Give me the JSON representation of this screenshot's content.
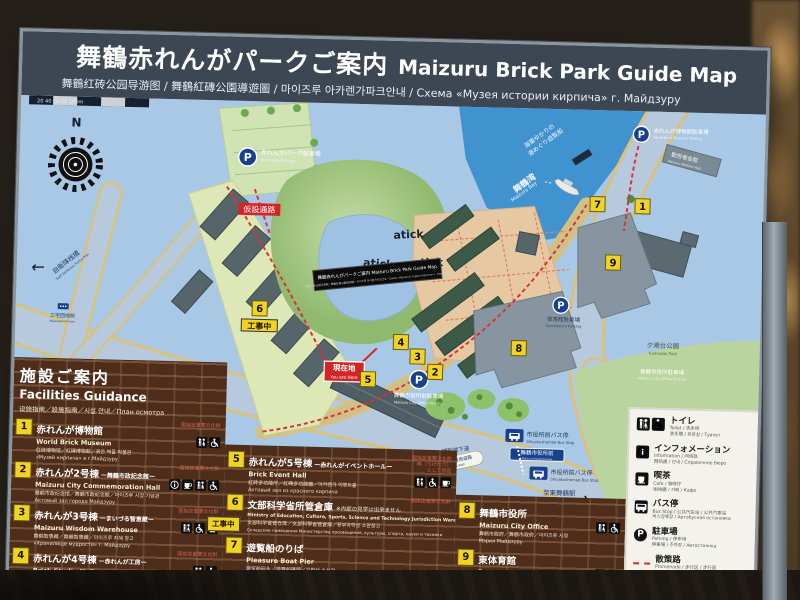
{
  "header": {
    "title_jp": "舞鶴赤れんがパークご案内",
    "title_en": "Maizuru Brick Park Guide Map",
    "subtitle": "舞鶴红砖公园导游图 / 舞鶴紅磚公園導遊圖 / 마이즈루 아카렌가파크안내 / Схема «Музея истории кирпича» г. Майдзуру"
  },
  "map": {
    "n": "N",
    "scale": "20   40   60   80   100m",
    "bay_jp": "舞鶴湾",
    "bay_en": "Maizuru Bay",
    "cruise1": "海軍ゆかりの",
    "cruise2": "港めぐり遊覧船",
    "p": "P",
    "p_brick_jp": "赤れんがパーク駐車場",
    "p_brick_en": "Brick Park Parking",
    "p_museum_jp": "赤れんが博物館駐車場",
    "p_museum_en": "World Brick Museum Parking",
    "p_office_jp": "舞鶴市役所前駐車場",
    "p_office_en": "Maizuru City Office Parking",
    "p_office2_jp": "舞鶴市役所駐車場",
    "p_office2_en": "Maizuru City Office Parking",
    "p_gym_jp": "体育館駐車場",
    "p_gym_en": "Gymnasium Parking",
    "hall_jp": "勤労者会館",
    "hall_en": "Maizuru Workers Hall",
    "park_jp": "夕潮台公園",
    "park_en": "Yushiodai Park",
    "youarehere_jp": "現在地",
    "youarehere_en": "You are Here",
    "temp_passage": "仮設通路",
    "construction": "工事中",
    "stickers": [
      "atick",
      "atick",
      "atick"
    ],
    "minisign1": "舞鶴赤れんがパークご案内 Maizuru Brick Park Guide Map",
    "minisign2": "舞鶴红砖公园导游图／舞鶴紅磚公園導遊圖／마이즈루 아카렌가파크안내／Схема «Музея истории кирпича» г. Майдзуру",
    "bus_jp": "市役所前バス停",
    "bus_en": "Shiyakushomae Bus Stop",
    "plate_jp": "舞鶴市役所前",
    "plate_en": "Maizurushiyakushomae",
    "sta_jp": "至東舞鶴駅",
    "sta_en": "JR Higashimaizuru Sta.",
    "under_jp": "補助地下道",
    "under_en": "Underground Passage",
    "bike_jp": "自転車・歩行者専用道路",
    "bike_en": "Pedestrian & Bike Path",
    "sdf_jp": "自衛隊桟橋",
    "sdf_en": "Self Defense Force Pier",
    "miyake_jp": "三宅団地前",
    "miyake_en": "Miyakedanchimae",
    "badges": [
      "1",
      "2",
      "3",
      "4",
      "5",
      "6",
      "7",
      "8",
      "9"
    ]
  },
  "facilities": {
    "title_jp": "施設ご案内",
    "title_en": "Facilities Guidance",
    "title_sub": "设施指南／設施指南／시설 안내／План осмотра",
    "designation": "国指定重要文化財",
    "desig5b": "棟（つけたり）",
    "desig5c": "として指定",
    "construction": "工事中",
    "items": [
      {
        "num": "1",
        "jp": "赤れんが博物館",
        "en": "World Brick Museum",
        "sub1": "红砖博物馆／紅磚博物館／붉은 벽돌 박물관",
        "sub2": "«Музей кирпича»  в г.Майдзуру"
      },
      {
        "num": "2",
        "jp": "赤れんが2号棟",
        "suffix": "ー舞鶴市政記念館ー",
        "en": "Maizuru City Commemoration Hall",
        "sub1": "舞鹤市政纪念馆／舞鶴市政紀念館／마이즈루 시정 기념관",
        "sub2": "Актовый зал города Майдзуру"
      },
      {
        "num": "3",
        "jp": "赤れんが3号棟",
        "suffix": "ーまいづる智恵蔵ー",
        "en": "Maizuru Wisdom Warehouse",
        "sub1": "舞鹤智惠藏／舞鶴智惠藏／마이즈루 지혜 창고",
        "sub2": "«Хранилище мудрости»  г. Майдзуру"
      },
      {
        "num": "4",
        "jp": "赤れんが4号棟",
        "suffix": "ー赤れんが工房ー",
        "en": "Brick Studio Hall",
        "sub1": "红砖活动室／紅磚活動室／아카렌가 공방",
        "sub2": "Кирпичная мастерская"
      },
      {
        "num": "5",
        "jp": "赤れんが5号棟",
        "suffix": "ー赤れんがイベントホールー",
        "en": "Brick Event Hall",
        "sub1": "红砖多功能厅／紅磚多功能廳／아카렌가 이벤트홀",
        "sub2": "Актовый зал из красного кирпича"
      },
      {
        "num": "6",
        "jp": "文部科学省所管倉庫",
        "note": "※内部の見学は出来ません",
        "en": "Ministry of Education, Culture, Sports, Science and Technology Jurisdiction Warehouses",
        "sub1": "文部科学省管仓库／文部科學省管倉庫／문부과학성 소관창고",
        "sub2": "Складские помещения Министерства просвещения, культуры, спорта, науки и техники"
      },
      {
        "num": "7",
        "jp": "遊覧船のりば",
        "en": "Pleasure Boat Pier",
        "sub1": "游览船码头／遊覽船碼頭／유람선 승선장",
        "sub2": "Причал прогулочного катера"
      },
      {
        "num": "8",
        "jp": "舞鶴市役所",
        "en": "Maizuru City Office",
        "sub1": "舞鹤市政府／舞鶴市政府／마이즈루 시청",
        "sub2": "Мэрия Майдзуру"
      },
      {
        "num": "9",
        "jp": "東体育館",
        "en": "East Gymnasium",
        "sub1": "东体育馆／東體育館／히가시 체육관",
        "sub2": "Восточный спортивный комплекс"
      }
    ]
  },
  "legend": {
    "items": [
      {
        "jp": "トイレ",
        "sub1": "Toilet / 洗手间",
        "sub2": "洗手間 / 화장실 / Туалет"
      },
      {
        "jp": "インフォメーション",
        "sub1": "Information / 问询处",
        "sub2": "問訊處 / 안내 / Справочное бюро"
      },
      {
        "jp": "喫茶",
        "sub1": "Cafe / 咖啡厅",
        "sub2": "咖啡廳 / 카페 / Кафе"
      },
      {
        "jp": "バス停",
        "sub1": "Bus Stop / 公共汽车站 / 公共汽車站",
        "sub2": "버스정류장 / Автобусная остановка"
      },
      {
        "jp": "駐車場",
        "sub1": "Parking / 停车场",
        "sub2": "停車場 / 주차장 / Автостоянка"
      },
      {
        "jp": "散策路",
        "sub1": "Promenade / 步行区 / 步行區",
        "sub2": "산책로 / Прогулочная дорожка"
      }
    ]
  },
  "colors": {
    "header_bg": "#3d4653",
    "map_land": "#a9c8e6",
    "sea": "#4193cf",
    "band_brick": "#4e2d1b",
    "badge_yellow": "#f0d323",
    "alert_red": "#d42525",
    "navy": "#17418c",
    "designation_red": "#d4604a"
  }
}
